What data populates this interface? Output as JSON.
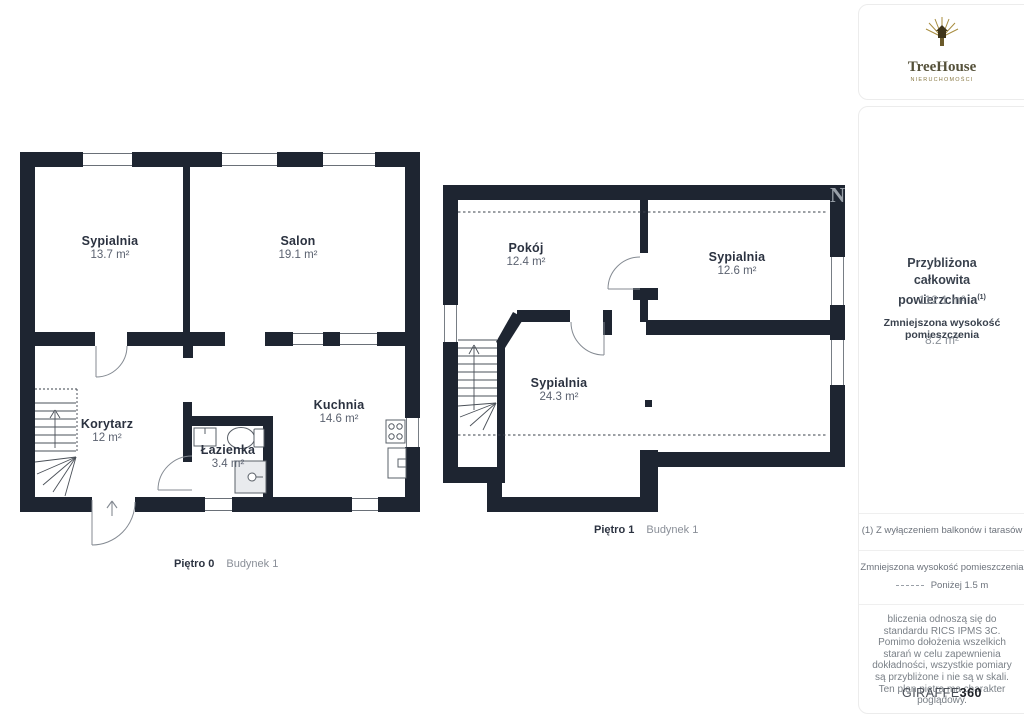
{
  "watermark": "N",
  "plans": [
    {
      "caption_floor": "Piętro 0",
      "caption_building": "Budynek 1",
      "rooms": [
        {
          "name": "Sypialnia",
          "area": "13.7 m²"
        },
        {
          "name": "Salon",
          "area": "19.1 m²"
        },
        {
          "name": "Korytarz",
          "area": "12 m²"
        },
        {
          "name": "Łazienka",
          "area": "3.4 m²"
        },
        {
          "name": "Kuchnia",
          "area": "14.6 m²"
        }
      ]
    },
    {
      "caption_floor": "Piętro 1",
      "caption_building": "Budynek 1",
      "rooms": [
        {
          "name": "Pokój",
          "area": "12.4 m²"
        },
        {
          "name": "Sypialnia",
          "area": "12.6 m²"
        },
        {
          "name": "Sypialnia",
          "area": "24.3 m²"
        }
      ]
    }
  ],
  "sidebar": {
    "logo": {
      "brand": "TreeHouse",
      "sub": "NIERUCHOMOŚCI"
    },
    "summary": {
      "total_label": "Przybliżona całkowita powierzchnia",
      "total_sup": "(1)",
      "total_value": "112.1 m²",
      "reduced_label": "Zmniejszona wysokość pomieszczenia",
      "reduced_value": "8.2 m²"
    },
    "footnote": "(1) Z wyłączeniem balkonów i tarasów",
    "legend": {
      "label": "Zmniejszona wysokość pomieszczenia",
      "value": "Poniżej 1.5 m"
    },
    "disclaimer": "bliczenia odnoszą się do standardu RICS IPMS 3C. Pomimo dołożenia wszelkich starań w celu zapewnienia dokładności, wszystkie pomiary są przybliżone i nie są w skali. Ten plan piętra ma charakter poglądowy.",
    "brand_footer": {
      "name": "GIRAFFE",
      "suffix": "360"
    }
  },
  "colors": {
    "wall": "#1e2531",
    "accent_gold": "#a88c3e"
  }
}
